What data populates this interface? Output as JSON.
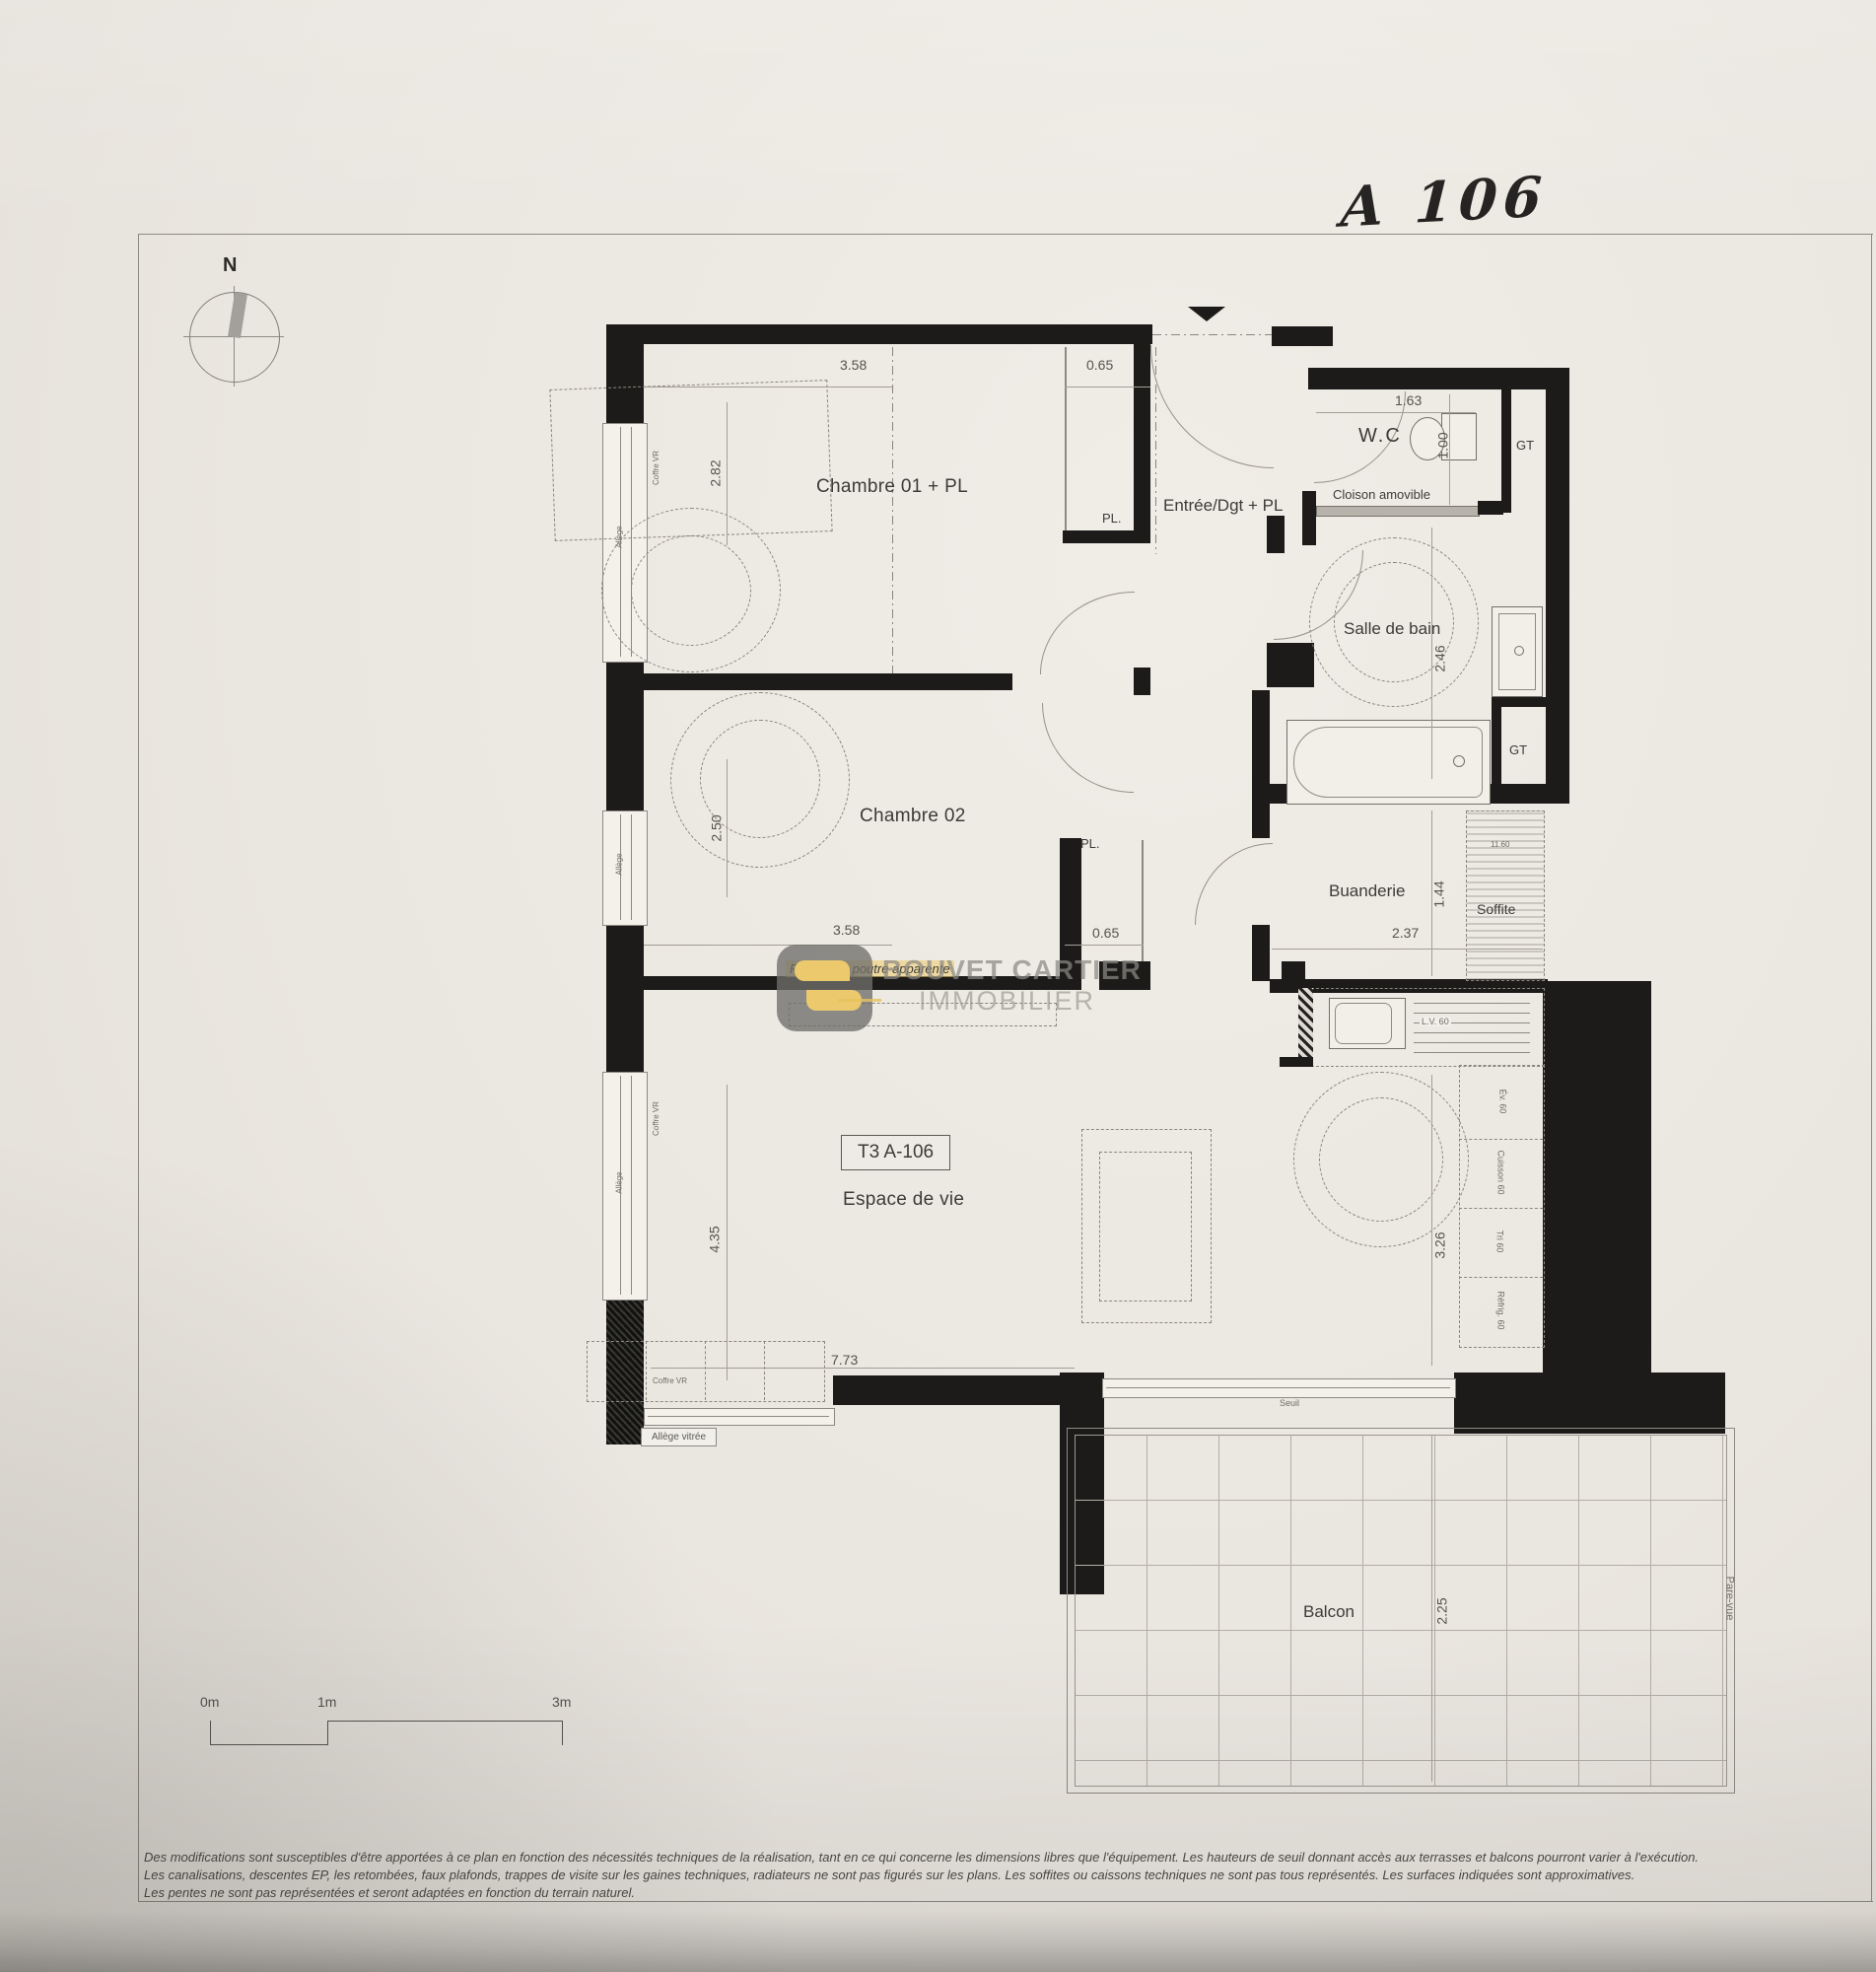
{
  "meta": {
    "handwritten": "A 106",
    "compass_n": "N"
  },
  "rooms": {
    "chambre01": "Chambre 01 + PL",
    "chambre02": "Chambre 02",
    "entree": "Entrée/Dgt + PL",
    "wc": "W.C",
    "salle_de_bain": "Salle de bain",
    "buanderie": "Buanderie",
    "soffite": "Soffite",
    "espace_de_vie": "Espace de vie",
    "balcon": "Balcon",
    "unit_box": "T3 A-106"
  },
  "small_labels": {
    "pl_ch01": "PL.",
    "pl_ch02": "PL.",
    "gt_wc": "GT",
    "gt_bain": "GT",
    "cloison_amovible": "Cloison amovible",
    "retombee": "Retombée poutre apparente",
    "seuil": "Seuil",
    "pare_vue": "Pare-vue",
    "allege_vitree": "Allège vitrée",
    "coffre_vr": "Coffre VR",
    "allege": "Allège",
    "lave_vaisselle": "L.V. 60",
    "soffite_dim": "11.60"
  },
  "kitchen_items": [
    "Év. 60",
    "Cuisson 60",
    "Tri 60",
    "Réfrig. 60"
  ],
  "dims": {
    "ch01_w": "3.58",
    "ch01_pl": "0.65",
    "ch01_h": "2.82",
    "wc_w": "1.63",
    "wc_d": "1.00",
    "sdb_h": "2.46",
    "ch02_h": "2.50",
    "ch02_w": "3.58",
    "ch02_pl": "0.65",
    "buanderie_h": "1.44",
    "buanderie_w": "2.37",
    "sejour_h": "4.35",
    "sejour_w": "7.73",
    "cuisine_h": "3.26",
    "balcon_d": "2.25"
  },
  "scale_bar": {
    "m0": "0m",
    "m1": "1m",
    "m3": "3m"
  },
  "watermark": {
    "name": "BOUVET CARTIER",
    "sub": "IMMOBILIER"
  },
  "disclaimer": [
    "Des modifications sont susceptibles d'être apportées à ce plan en fonction des nécessités techniques de la réalisation, tant en ce qui concerne les dimensions libres que l'équipement. Les hauteurs de seuil donnant accès aux terrasses et balcons pourront varier à l'exécution.",
    "Les canalisations, descentes EP, les retombées, faux plafonds, trappes de visite sur les gaines techniques, radiateurs ne sont pas figurés sur les plans. Les soffites ou caissons techniques ne sont pas tous représentés. Les surfaces indiquées sont approximatives.",
    "Les pentes ne sont pas représentées et seront adaptées en fonction du terrain naturel."
  ],
  "colors": {
    "wall": "#1c1b19",
    "paper": "#eae6e0",
    "accent_yellow": "#e5bb4d",
    "watermark_gray": "#97938c"
  }
}
